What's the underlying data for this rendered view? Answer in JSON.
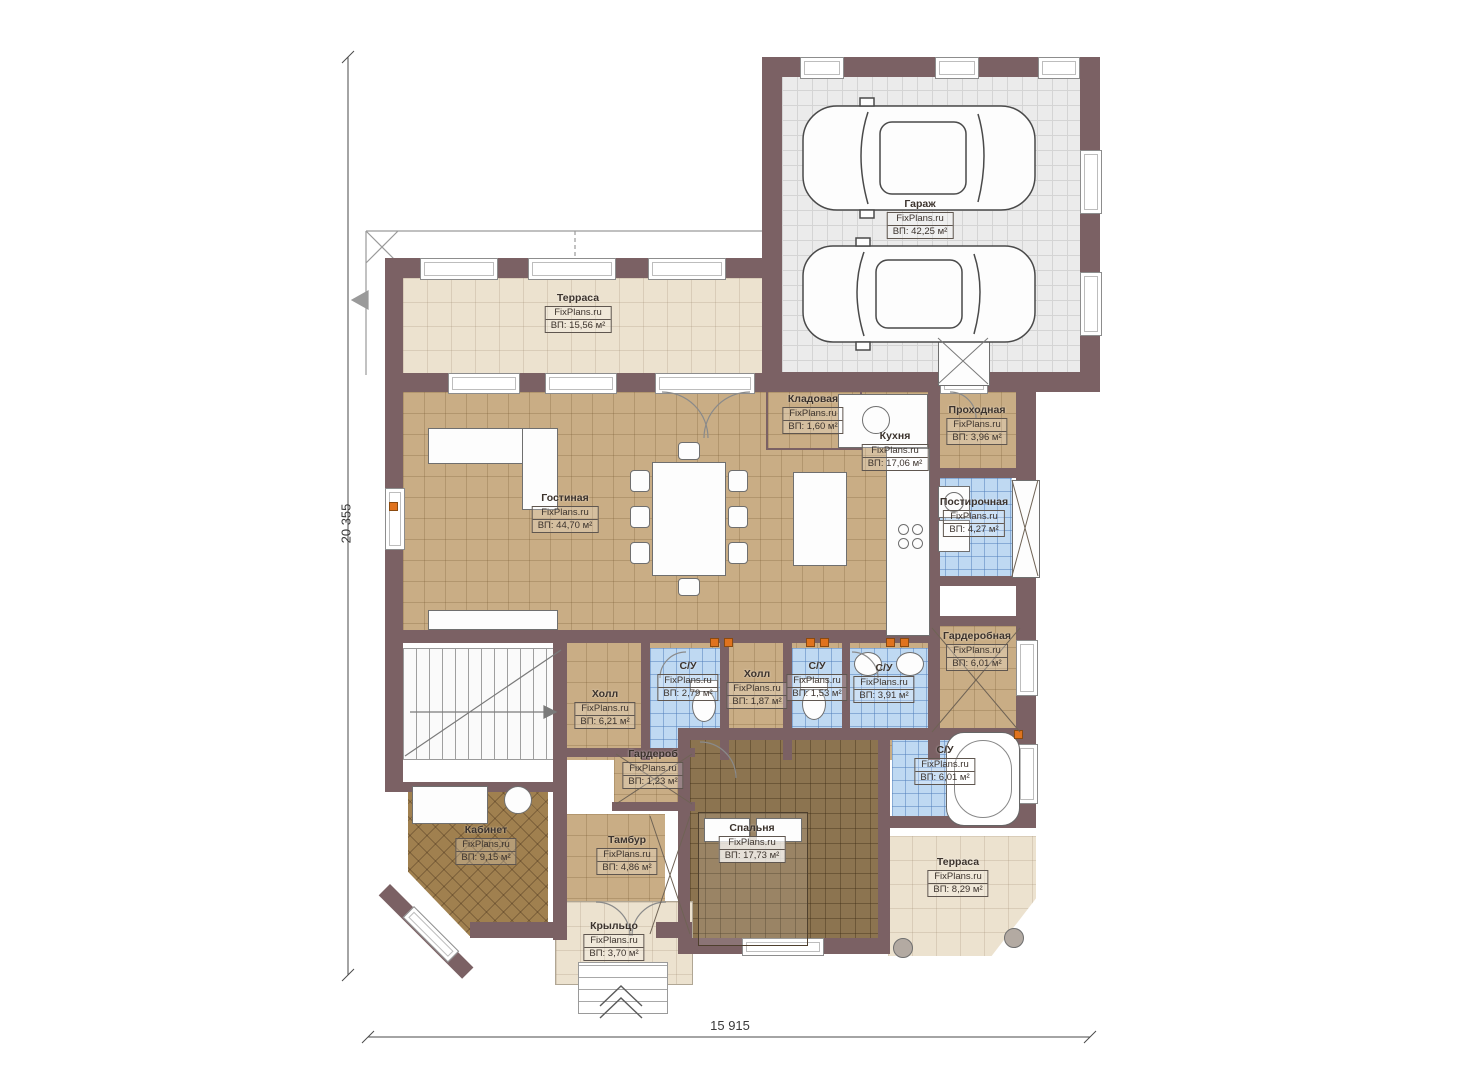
{
  "meta": {
    "brand": "FixPlans.ru",
    "area_prefix": "ВП:"
  },
  "rooms": [
    {
      "name": "Гараж",
      "area": "ВП: 42,25 м²"
    },
    {
      "name": "Терраса",
      "area": "ВП: 15,56 м²"
    },
    {
      "name": "Гостиная",
      "area": "ВП: 44,70 м²"
    },
    {
      "name": "Кладовая",
      "area": "ВП: 1,60 м²"
    },
    {
      "name": "Кухня",
      "area": "ВП: 17,06 м²"
    },
    {
      "name": "Проходная",
      "area": "ВП: 3,96 м²"
    },
    {
      "name": "Постирочная",
      "area": "ВП: 4,27 м²"
    },
    {
      "name": "Гардеробная",
      "area": "ВП: 6,01 м²"
    },
    {
      "name": "Холл",
      "area": "ВП: 6,21 м²"
    },
    {
      "name": "С/У",
      "area": "ВП: 2,79 м²"
    },
    {
      "name": "Холл",
      "area": "ВП: 1,87 м²"
    },
    {
      "name": "С/У",
      "area": "ВП: 1,53 м²"
    },
    {
      "name": "С/У",
      "area": "ВП: 3,91 м²"
    },
    {
      "name": "Гардероб",
      "area": "ВП: 1,23 м²"
    },
    {
      "name": "Кабинет",
      "area": "ВП: 9,15 м²"
    },
    {
      "name": "Тамбур",
      "area": "ВП: 4,86 м²"
    },
    {
      "name": "Спальня",
      "area": "ВП: 17,73 м²"
    },
    {
      "name": "С/У",
      "area": "ВП: 6,01 м²"
    },
    {
      "name": "Терраса",
      "area": "ВП: 8,29 м²"
    },
    {
      "name": "Крыльцо",
      "area": "ВП: 3,70 м²"
    }
  ],
  "dimensions": {
    "height_mm": "20 355",
    "width_mm": "15 915"
  },
  "colors": {
    "wall": "#7b6164",
    "floor_tan": "#c9ad85",
    "floor_blue": "#bfd9f2",
    "floor_bedroom": "#8c7450",
    "floor_beige": "#ece2cf",
    "accent_orange": "#e0731e"
  }
}
